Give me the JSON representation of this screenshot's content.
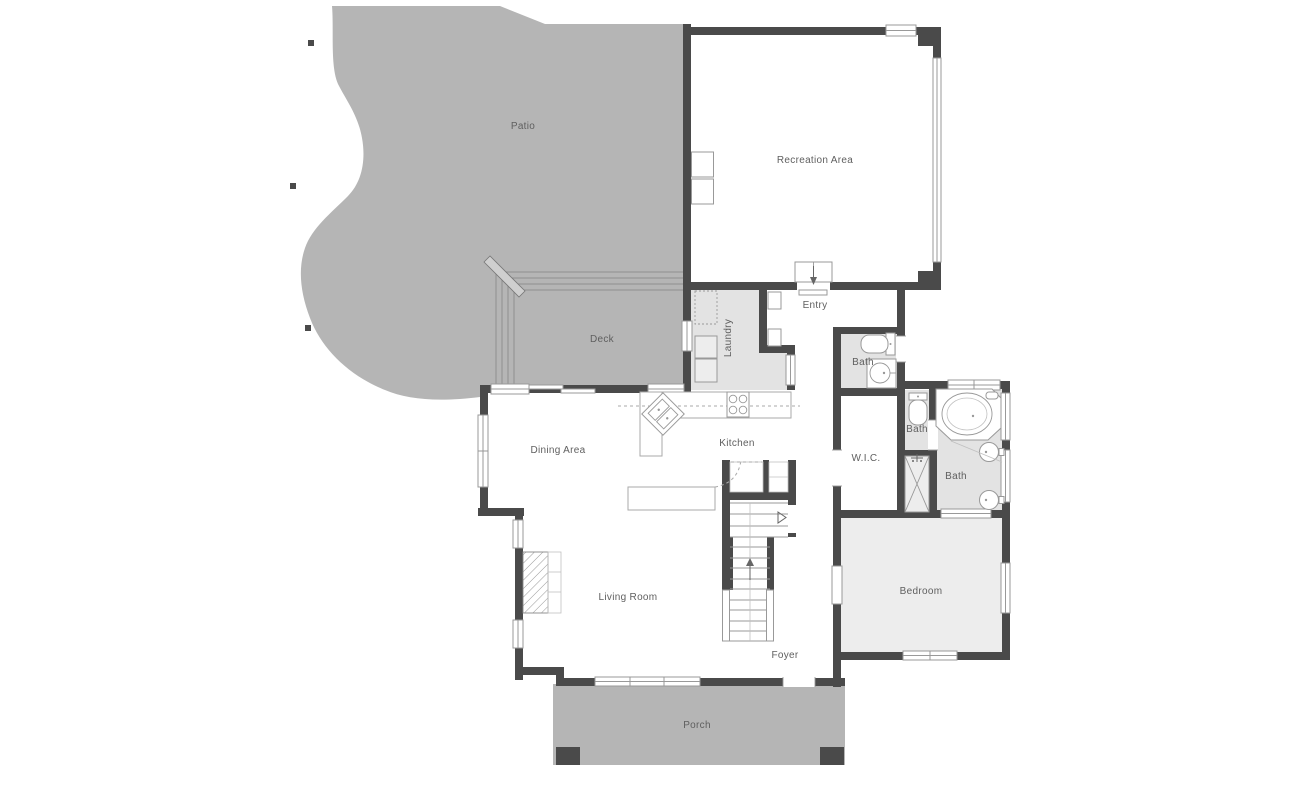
{
  "colors": {
    "background": "#ffffff",
    "wall": "#4a4a4a",
    "outdoor": "#b5b5b5",
    "room_gray": "#e3e3e3",
    "bedroom_gray": "#ededed",
    "fixture_line": "#999999",
    "deck_line": "#8f8f8f",
    "counter_line": "#aaaaaa",
    "label": "#5f5f5f"
  },
  "rooms": {
    "patio": {
      "label": "Patio"
    },
    "recreation": {
      "label": "Recreation Area"
    },
    "deck": {
      "label": "Deck"
    },
    "laundry": {
      "label": "Laundry"
    },
    "entry": {
      "label": "Entry"
    },
    "bath_entry": {
      "label": "Bath"
    },
    "bath_hall": {
      "label": "Bath"
    },
    "bath_master": {
      "label": "Bath"
    },
    "wic": {
      "label": "W.I.C."
    },
    "dining": {
      "label": "Dining Area"
    },
    "kitchen": {
      "label": "Kitchen"
    },
    "living": {
      "label": "Living Room"
    },
    "foyer": {
      "label": "Foyer"
    },
    "bedroom": {
      "label": "Bedroom"
    },
    "porch": {
      "label": "Porch"
    }
  }
}
